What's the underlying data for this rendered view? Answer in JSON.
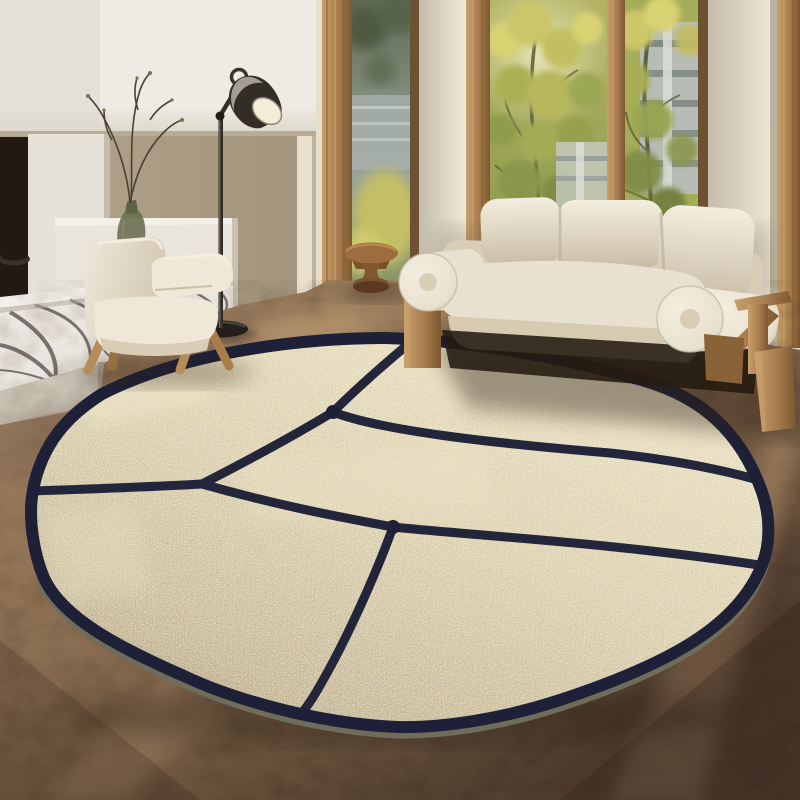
{
  "meta": {
    "title": "Round cream rug with navy abstract lines in a modern living room",
    "description": "Lifestyle product photo: a large round beige tufted rug with dark navy geometric dividing lines lies on a warm brown floor. A cream boucle sofa with bolster arms and oak frame sits behind it by tall oak-framed windows with sunlit trees. To the left: a white fireplace volume with a veined marble bench, a green glass vase with branches, a dark metal task floor lamp and a cream Jeanneret-style armchair. A small round wooden pedestal side table stands by the window."
  },
  "scene": {
    "objects": [
      {
        "name": "round-rug",
        "label": "Round beige rug with navy line pattern and stitched edge"
      },
      {
        "name": "sofa",
        "label": "Cream boucle three-seat sofa with cylindrical bolsters and oak frame"
      },
      {
        "name": "armchair",
        "label": "Cream boucle armchair with splayed oak legs"
      },
      {
        "name": "floor-lamp",
        "label": "Dark metal task floor lamp"
      },
      {
        "name": "side-table",
        "label": "Round wooden pedestal side table"
      },
      {
        "name": "marble-console",
        "label": "Veined marble bench with white cabinet"
      },
      {
        "name": "fireplace",
        "label": "White plaster fireplace volume with dark firebox slot"
      },
      {
        "name": "vase",
        "label": "Green glass vase with dry branches"
      },
      {
        "name": "bowl",
        "label": "Small dark bowl on marble"
      },
      {
        "name": "window-wall",
        "label": "Floor-to-ceiling oak-framed windows with sunlit trees and building outside"
      },
      {
        "name": "floor",
        "label": "Warm brown stone floor with sunlight streaks"
      }
    ]
  },
  "palette": {
    "wall_left": "#b3a58d",
    "wall_left_dark": "#a3957d",
    "wall_lit": "#e8e0cc",
    "pier_light": "#efe9db",
    "pier_shade": "#c6bcaa",
    "white_panel": "#edebe3",
    "panel_shadow": "#b9ac96",
    "cavity": "#221a12",
    "pillar": "#e6e2d7",
    "cabinet": "#e9e5da",
    "marble": "#eae7e0",
    "marble_vein": "#544c4b",
    "plinth": "#cfc9bc",
    "wood": "#a87c4e",
    "wood_dark": "#7c5830",
    "wood_light": "#c9a06b",
    "glass_dim": "#828e7f",
    "building": "#b7bdb6",
    "building_band": "#7f8a84",
    "foliage_bright": "#d8d273",
    "foliage_mid": "#a8ae56",
    "foliage_dark": "#6f7b41",
    "floor_main": "#8a6e52",
    "floor_light": "#b3926c",
    "floor_bright": "#c9a87c",
    "floor_dark": "#54402f",
    "floor_mauve": "#7b6555",
    "rug_field": "#d7cba9",
    "rug_light": "#f0e7cb",
    "rug_shade": "#b9ab88",
    "rug_navy": "#1d2037",
    "rug_serge": "#6e6d5b",
    "sofa_cream": "#e9e1cf",
    "sofa_hi": "#f4eee0",
    "sofa_shade": "#c9bda6",
    "sofa_dark": "#241a10",
    "chair_cream": "#efe8d9",
    "chair_shade": "#d2c7b1",
    "lamp_metal": "#332d27",
    "lamp_hi": "#b8b2a8",
    "lamp_inner": "#f4ecd6",
    "vase": "#6e7252",
    "twig": "#4a4233",
    "table_wood": "#9c6d3f",
    "table_dark": "#6a4625",
    "table_light": "#bd8a50",
    "shadow": "#2e2317"
  }
}
